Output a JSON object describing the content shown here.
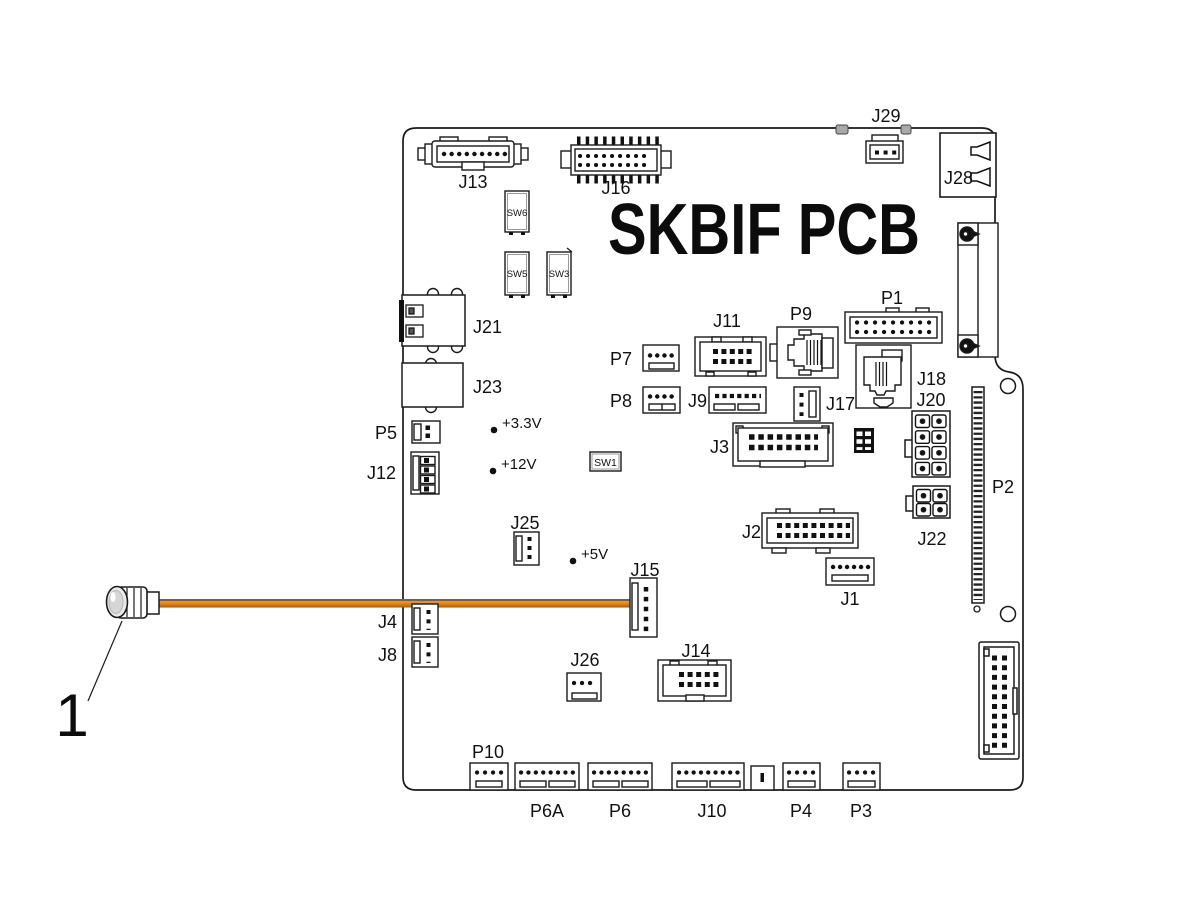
{
  "diagram": {
    "title": "SKBIF PCB",
    "callout": "1",
    "colors": {
      "wire": "#e2820f",
      "outline": "#1a1a1a"
    },
    "labels": {
      "j13": "J13",
      "j16": "J16",
      "j29": "J29",
      "j28": "J28",
      "sw6": "SW6",
      "sw5": "SW5",
      "sw3": "SW3",
      "sw1": "SW1",
      "j21": "J21",
      "j23": "J23",
      "p5": "P5",
      "j12": "J12",
      "j25": "J25",
      "j15": "J15",
      "j4": "J4",
      "j8": "J8",
      "j26": "J26",
      "j14": "J14",
      "p7": "P7",
      "p8": "P8",
      "j9": "J9",
      "j11": "J11",
      "p9": "P9",
      "p1": "P1",
      "j17": "J17",
      "j18": "J18",
      "j3": "J3",
      "j2": "J2",
      "j1": "J1",
      "j20": "J20",
      "j22": "J22",
      "p2": "P2",
      "p10": "P10",
      "p6a": "P6A",
      "p6": "P6",
      "j10": "J10",
      "p4": "P4",
      "p3": "P3"
    },
    "test_points": {
      "v33": "+3.3V",
      "v12": "+12V",
      "v5": "+5V"
    }
  }
}
